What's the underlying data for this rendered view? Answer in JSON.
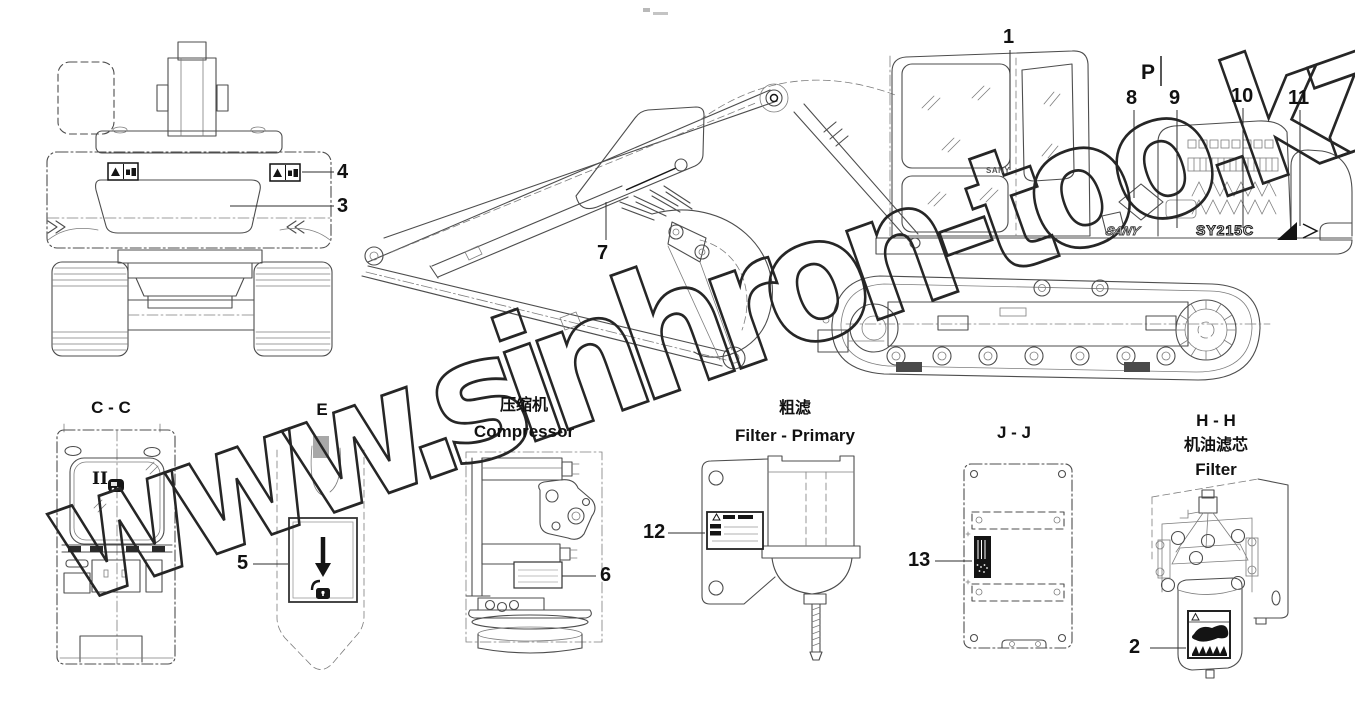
{
  "diagram": {
    "watermark": "www.sinhron-too.kz",
    "machine": {
      "cab_brand_decal": "SANY",
      "model_decal": "SY215C",
      "side_logo_decal": "SANY"
    },
    "markers": {
      "section_p": "P",
      "roman_numeral": "II"
    },
    "callouts": {
      "c1": "1",
      "c2": "2",
      "c3": "3",
      "c4": "4",
      "c5": "5",
      "c6": "6",
      "c7": "7",
      "c8": "8",
      "c9": "9",
      "c10": "10",
      "c11": "11",
      "c12": "12",
      "c13": "13"
    },
    "sections": {
      "cc": {
        "title": "C - C"
      },
      "e": {
        "title": "E"
      },
      "compressor": {
        "title_zh": "压缩机",
        "title_en": "Compressor"
      },
      "filter_primary": {
        "title_zh": "粗滤",
        "title_en": "Filter - Primary"
      },
      "jj": {
        "title": "J - J"
      },
      "hh": {
        "title": "H - H",
        "subtitle_zh": "机油滤芯",
        "subtitle_en": "Filter"
      }
    }
  }
}
